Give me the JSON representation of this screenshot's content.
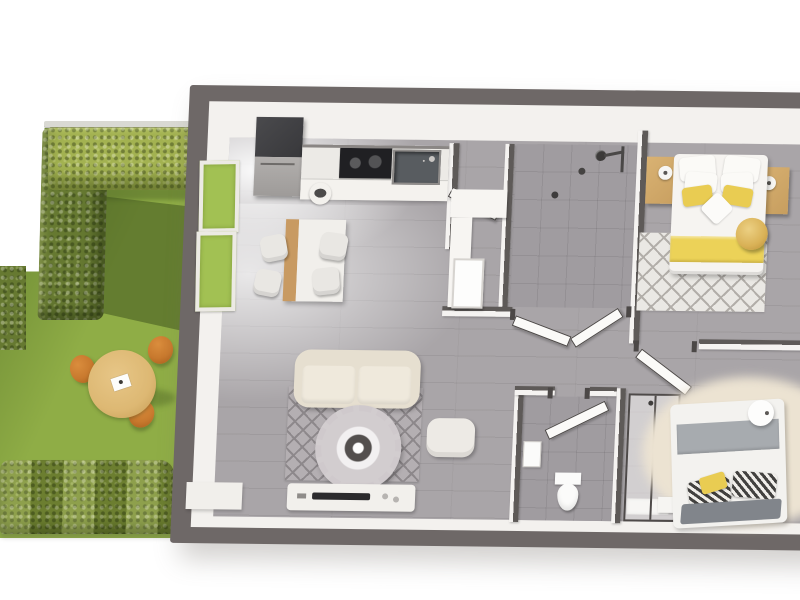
{
  "scene": {
    "title": "3D rendered top-down floor plan of an apartment with adjoining hedged garden",
    "background": "#ffffff"
  },
  "colors": {
    "wall_dark": "#6e6867",
    "wall_face": "#f3f1ee",
    "wall_int_dark": "#5e5a58",
    "wall_int_face": "#f5f3f1",
    "floor": "#a9a5a8",
    "floor_tile": "#a09ca0",
    "lawn": "#8fad46",
    "lawn_dark": "#64802f",
    "hedge_light": "#a3b251",
    "hedge_mid": "#7d9138",
    "hedge_dark": "#667931",
    "fence": "#d9d9d3",
    "garden_table": "#ddb873",
    "garden_chair": "#c8792e",
    "window_green": "#a2c153",
    "fridge_dark": "#38383b",
    "fridge_steel": "#9e9b99",
    "counter": "#eceae6",
    "cooktop": "#202023",
    "sink": "#585c60",
    "dining_wood": "#c89a62",
    "chair_white": "#e9e7e3",
    "bench": "#f7f5f2",
    "door": "#fbfaf8",
    "door_frame": "#4c4847",
    "toilet": "#fbfbfa",
    "glass_frame": "#4e4a49",
    "sofa": "#e6dfd0",
    "sofa_cushion": "#efe9dc",
    "rug": "#b4afb2",
    "rug_line": "#8d888b",
    "fringe": "#d2cdcf",
    "ring_dark": "#534f4e",
    "pouf_white": "#edeae5",
    "console": "#f2f0ec",
    "tv": "#2c2b2d",
    "bed_white": "#f6f4f1",
    "bed_yellow": "#ecd258",
    "pillow_yellow": "#e9cc52",
    "nightstand": "#c79e5f",
    "bedroom_rug": "#eae8e4",
    "lattice": "#b2aea9",
    "pouf_gold": "#d9b156",
    "blanket_gray": "#a7abaf",
    "fold_gray": "#81858b",
    "rug2_beige": "#ece3d2"
  },
  "garden": {
    "landscaping": [
      "tall-hedge",
      "top-hedge",
      "bottom-hedge",
      "left-hedge",
      "lawn",
      "fence-rail"
    ],
    "furniture": {
      "table": "round-wood-bistro-table",
      "chair_type": "orange-bistro-chair",
      "chair_count": 3
    }
  },
  "house": {
    "style": "top-down 3D cutaway, dark grey exterior walls, grey plank floor",
    "rooms": [
      {
        "name": "kitchen-dining",
        "items": [
          "tall-fridge",
          "kitchen-counter",
          "cooktop",
          "sink",
          "waste-bin",
          "dining-table",
          "dining-chairs x4",
          "garden-windows x2"
        ]
      },
      {
        "name": "living-room",
        "items": [
          "beige-sofa",
          "diamond-pattern-rug",
          "fringed-round-coffee-table",
          "white-pouf",
          "tv-console",
          "tv",
          "side-cabinet"
        ]
      },
      {
        "name": "laundry-room",
        "items": [
          "l-shaped-bench",
          "basin",
          "open-door"
        ]
      },
      {
        "name": "shower-room",
        "items": [
          "rain-shower-head",
          "hand-shower",
          "floor-drain",
          "glass-doors"
        ]
      },
      {
        "name": "wc",
        "items": [
          "toilet",
          "wall-basin",
          "open-door"
        ]
      },
      {
        "name": "master-bedroom",
        "items": [
          "double-bed-yellow-accents",
          "white-pillows x4",
          "yellow-pillows x2",
          "throw-pillow",
          "nightstands x2",
          "table-lamps x2",
          "lattice-rug",
          "gold-pouf",
          "open-door"
        ]
      },
      {
        "name": "second-bedroom",
        "items": [
          "double-bed-grey-blanket",
          "patterned-pillows x2",
          "yellow-cushion",
          "round-side-table",
          "nightstand",
          "ensuite-shower-enclosure",
          "beige-round-rug"
        ]
      }
    ]
  }
}
